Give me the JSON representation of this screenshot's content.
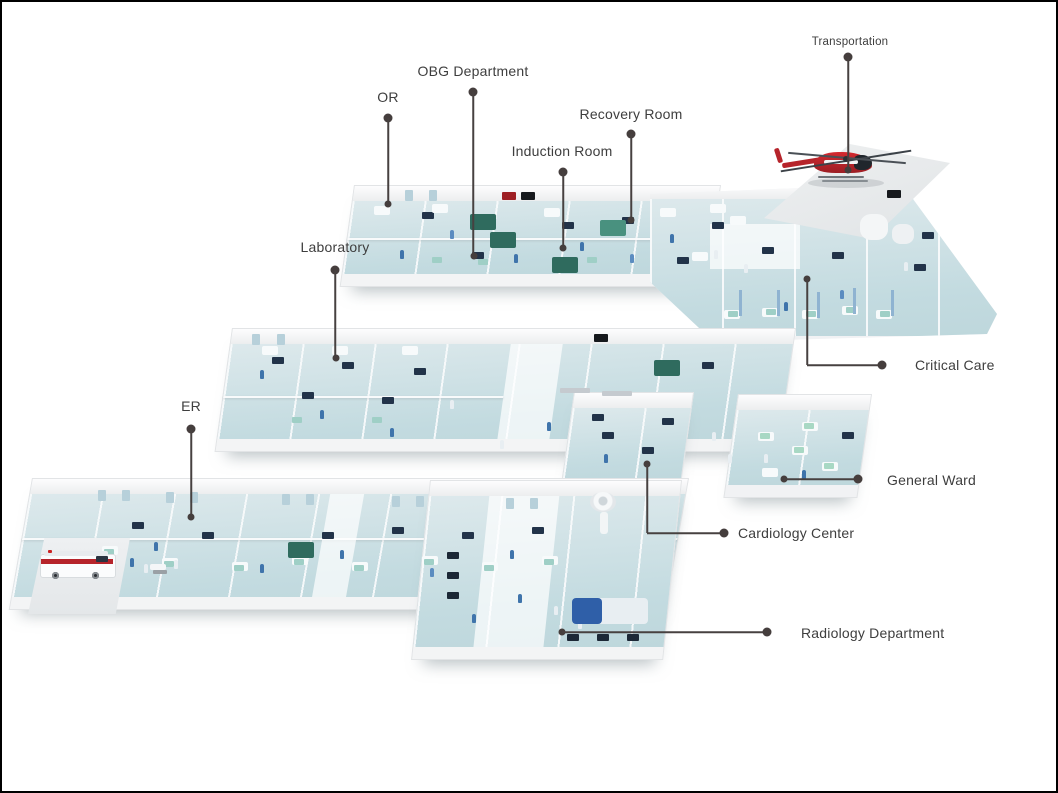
{
  "colors": {
    "background": "#ffffff",
    "frame": "#000000",
    "label": "#3e3e3e",
    "leader": "#474140",
    "dot": "#453e3d",
    "floor-teal": "#c9dfe4",
    "wall-white": "#f3f4f5",
    "accent-red": "#c1272d",
    "equipment-navy": "#223349",
    "curtain-green": "#2f6b5e",
    "scrubs-blue": "#3f74ab"
  },
  "illustration": {
    "type": "isometric-hospital-floor-plan",
    "helicopter": "red-helicopter-on-helipad-icon",
    "ambulance": "ambulance-at-er-entrance-icon"
  },
  "callouts": {
    "transportation": {
      "label": "Transportation"
    },
    "obg": {
      "label": "OBG Department"
    },
    "or": {
      "label": "OR"
    },
    "recovery": {
      "label": "Recovery Room"
    },
    "induction": {
      "label": "Induction Room"
    },
    "laboratory": {
      "label": "Laboratory"
    },
    "critical_care": {
      "label": "Critical Care"
    },
    "er": {
      "label": "ER"
    },
    "general_ward": {
      "label": "General Ward"
    },
    "cardiology": {
      "label": "Cardiology Center"
    },
    "radiology": {
      "label": "Radiology Department"
    }
  }
}
